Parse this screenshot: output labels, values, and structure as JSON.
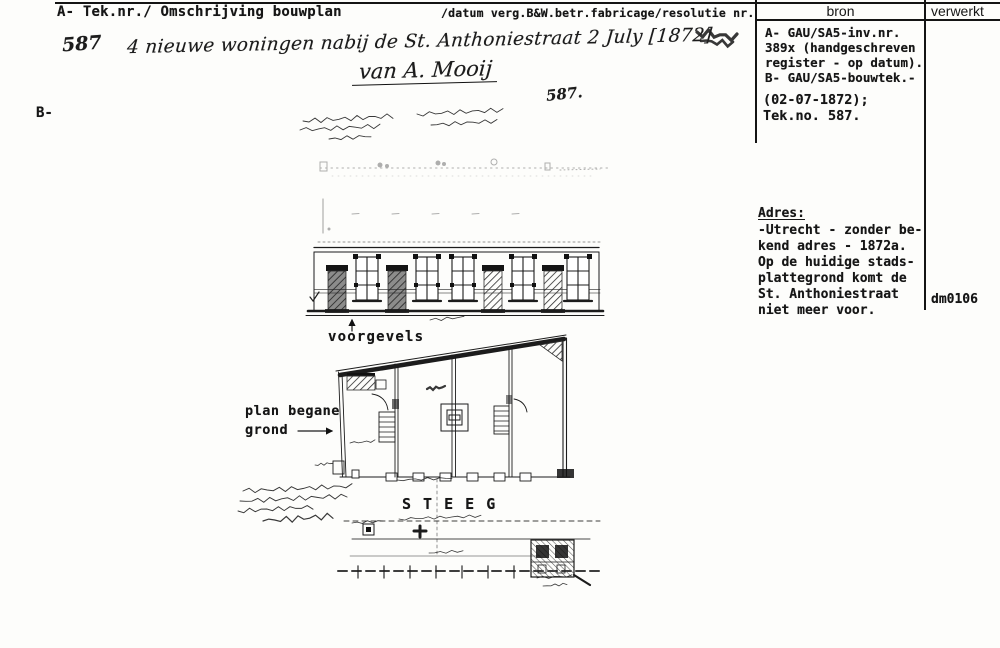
{
  "header": {
    "left_label": "A- Tek.nr./ Omschrijving bouwplan",
    "right_label": "/datum verg.B&W.betr.fabricage/resolutie nr.",
    "bron_col": "bron",
    "verwerkt_col": "verwerkt"
  },
  "section_b_label": "B-",
  "handwriting": {
    "tek_nr": "587",
    "description": "4 nieuwe woningen nabij de St. Anthoniestraat 2 July [1872]",
    "applicant": "van A. Mooij",
    "sheet_nr": "587."
  },
  "bron_panel": {
    "source_text": "A- GAU/SA5-inv.nr.\n389x (handgeschreven\nregister - op datum).\nB- GAU/SA5-bouwtek.-",
    "date_text": "(02-07-1872);\nTek.no. 587.",
    "adres_title": "Adres:",
    "adres_text": "-Utrecht - zonder be-\nkend adres - 1872a.\nOp de huidige stads-\nplattegrond komt de\nSt. Anthoniestraat\nniet meer voor."
  },
  "verwerkt_panel": {
    "code": "dm0106"
  },
  "drawing_labels": {
    "voorgevels": "voorgevels",
    "plan_line1": "plan begane",
    "plan_line2": "grond",
    "steeg": "S T E E G"
  },
  "colors": {
    "ink": "#161616",
    "paper": "#fdfdfb"
  }
}
